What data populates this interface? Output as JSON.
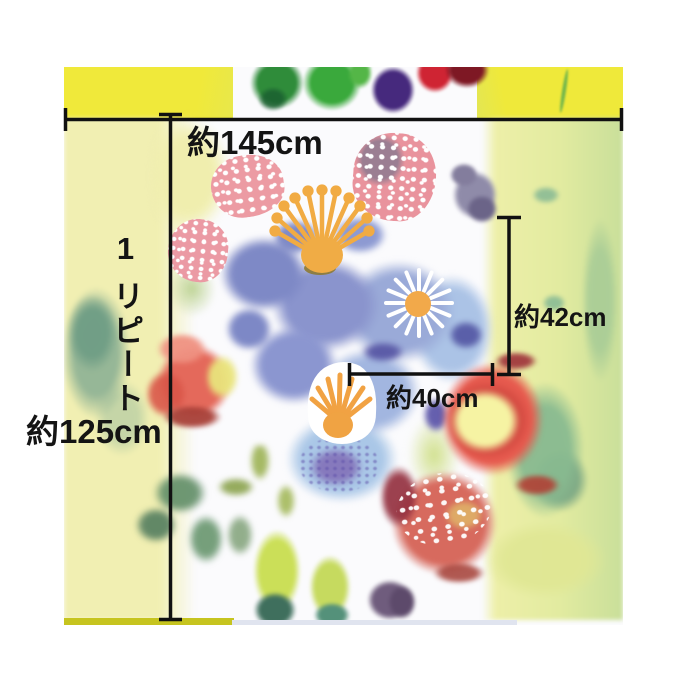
{
  "image_type": "fabric swatch measurement diagram",
  "labels": {
    "width": "約145cm",
    "repeat_count": "1",
    "repeat_word": "リピート",
    "height": "約125cm",
    "motif_height": "約42cm",
    "motif_width": "約40cm"
  },
  "palette": {
    "line": "#111111",
    "selvage_yellow": "#efe93a",
    "pale_yellow": "#f1efb2",
    "leaf_green": "#3aa93c",
    "sage_green": "#7fa98e",
    "blue": "#8a94cd",
    "light_blue": "#abc3e6",
    "berry_pink": "#e9939d",
    "red": "#e65a4e",
    "stamen_orange": "#f1ab43",
    "purple": "#46297d",
    "ground_white": "#fbfbfd"
  }
}
